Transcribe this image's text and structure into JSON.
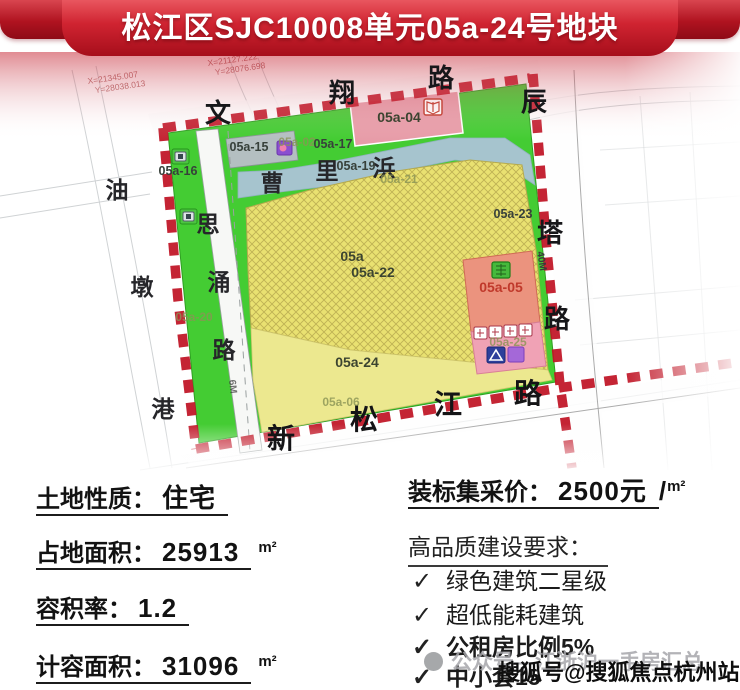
{
  "banner": {
    "title": "松江区SJC10008单元05a-24号地块"
  },
  "map": {
    "survey_coords": {
      "g1x": "X=21345.007",
      "g1y": "Y=28038.013",
      "g2x": "X=21127.222",
      "g2y": "Y=28076.698"
    },
    "road_chars": {
      "wenxiang": [
        "文",
        "翔",
        "路"
      ],
      "chenta": [
        "辰",
        "塔",
        "路"
      ],
      "xinsongjiang": [
        "新",
        "松",
        "江",
        "路"
      ],
      "youdungang": [
        "油",
        "墩",
        "港"
      ],
      "siyong": [
        "思",
        "涌",
        "路"
      ],
      "caolibang": [
        "曹",
        "里",
        "浜"
      ]
    },
    "width_labels": {
      "w40": "40M",
      "w6": "6M"
    },
    "parcels": {
      "a15": "05a-15",
      "a02": "05a-02",
      "a17": "05a-17",
      "a16": "05a-16",
      "a19": "05a-19",
      "a04": "05a-04",
      "a21": "05a-21",
      "a23": "05a-23",
      "a05": "05a",
      "a22": "05a-22",
      "a20": "05a-20",
      "a24": "05a-24",
      "a05p": "05a-05",
      "a25": "05a-25",
      "a06": "05a-06"
    }
  },
  "info": {
    "left": [
      {
        "label": "土地性质：",
        "value": "住宅",
        "unit": ""
      },
      {
        "label": "占地面积：",
        "value": "25913",
        "unit": "m²"
      },
      {
        "label": "容积率：",
        "value": "1.2",
        "unit": ""
      },
      {
        "label": "计容面积：",
        "value": "31096",
        "unit": "m²"
      }
    ],
    "price": {
      "label": "装标集采价：",
      "value": "2500元",
      "slash": "/",
      "unit": "m²"
    },
    "requirements": {
      "title": "高品质建设要求：",
      "check": "✓",
      "items": [
        {
          "text": "绿色建筑二星级"
        },
        {
          "text": "超低能耗建筑"
        },
        {
          "text": "公租房比例5%"
        },
        {
          "text": "中小套15"
        }
      ]
    }
  },
  "watermarks": {
    "gray": "公众号—江浙沪一手房汇总",
    "black": "搜狐号@搜狐焦点杭州站"
  }
}
